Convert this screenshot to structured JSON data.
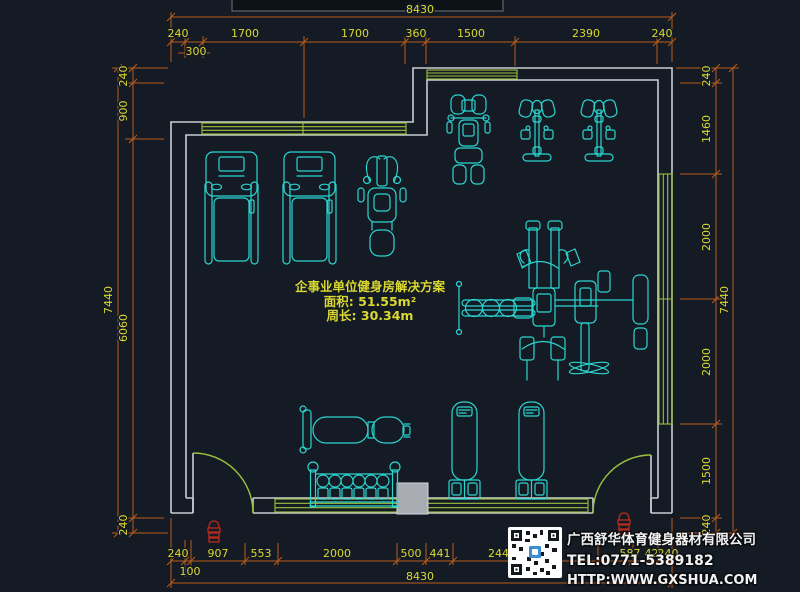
{
  "colors": {
    "bg": "#151B24",
    "wall": "#C9CDD2",
    "green": "#9CC13C",
    "cyan": "#2BD5D0",
    "dim": "#B95B1D",
    "dimtext": "#D9D831",
    "red": "#BB2A1E",
    "colgray": "#A9ADB3"
  },
  "title_block": {
    "project_title": "企事业单位健身房解决方案",
    "area_label": "面积: 51.55m²",
    "perimeter_label": "周长: 30.34m"
  },
  "company": {
    "name": "广西舒华体育健身器材有限公司",
    "tel": "TEL:0771-5389182",
    "website": "HTTP:WWW.GXSHUA.COM"
  },
  "dimensions": {
    "overall_width_top": "8430",
    "overall_width_bottom": "8430",
    "overall_height_left": "7440",
    "overall_height_right": "7440",
    "top_chain": [
      "240",
      "300",
      "1700",
      "1700",
      "360",
      "1500",
      "2390",
      "240"
    ],
    "left_chain": [
      "240",
      "900",
      "6060",
      "240"
    ],
    "right_chain": [
      "240",
      "1460",
      "2000",
      "2000",
      "1500",
      "240"
    ],
    "bottom_chain": [
      "240",
      "100",
      "907",
      "553",
      "2000",
      "500",
      "441",
      "2442",
      "587",
      "420",
      "240"
    ]
  }
}
